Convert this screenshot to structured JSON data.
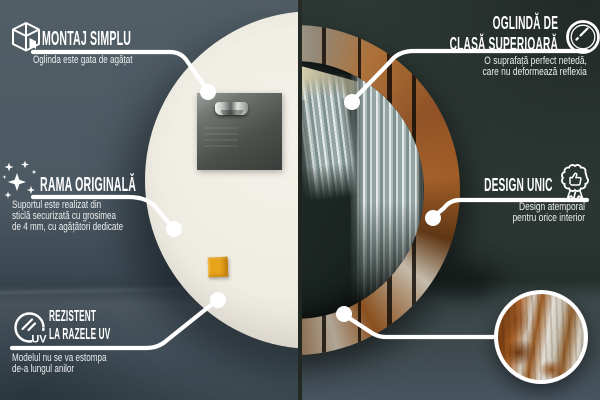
{
  "scene": {
    "left_view": "mirror-back-panel",
    "right_view": "mirror-front-rustic-frame",
    "detail_view": "frame-texture-zoom"
  },
  "colors": {
    "left_wall": "#4c5962",
    "right_wall": "#2c3733",
    "divider": "#1e2420",
    "mirror_back_disc": "#efece3",
    "sticker_orange": "#e8a41b",
    "rust_frame": "#8a4a1c",
    "callout_white": "#ffffff"
  },
  "callouts": {
    "montaj": {
      "icon": "package-box-icon",
      "title": [
        "MONTAJ SIMPLU"
      ],
      "body": [
        "Oglinda este gata de agățat"
      ]
    },
    "oglinda": {
      "icon": "mirror-shine-icon",
      "title": [
        "OGLINDĂ DE",
        "CLASĂ SUPERIOARĂ"
      ],
      "body": [
        "O suprafață perfect netedă,",
        "care nu deformează reflexia"
      ]
    },
    "rama": {
      "icon": "sparkles-icon",
      "title": [
        "RAMA ORIGINALĂ"
      ],
      "body": [
        "Suportul este realizat din",
        "sticlă securizată cu grosimea",
        "de 4 mm, cu agățători dedicate"
      ]
    },
    "design": {
      "icon": "award-badge-icon",
      "title": [
        "DESIGN UNIC"
      ],
      "body": [
        "Design atemporal",
        "pentru orice interior"
      ]
    },
    "uv": {
      "icon": "uv-rays-icon",
      "icon_label": "UV",
      "title": [
        "REZISTENT",
        "LA RAZELE UV"
      ],
      "body": [
        "Modelul nu se va estompa",
        "de-a lungul anilor"
      ]
    }
  }
}
